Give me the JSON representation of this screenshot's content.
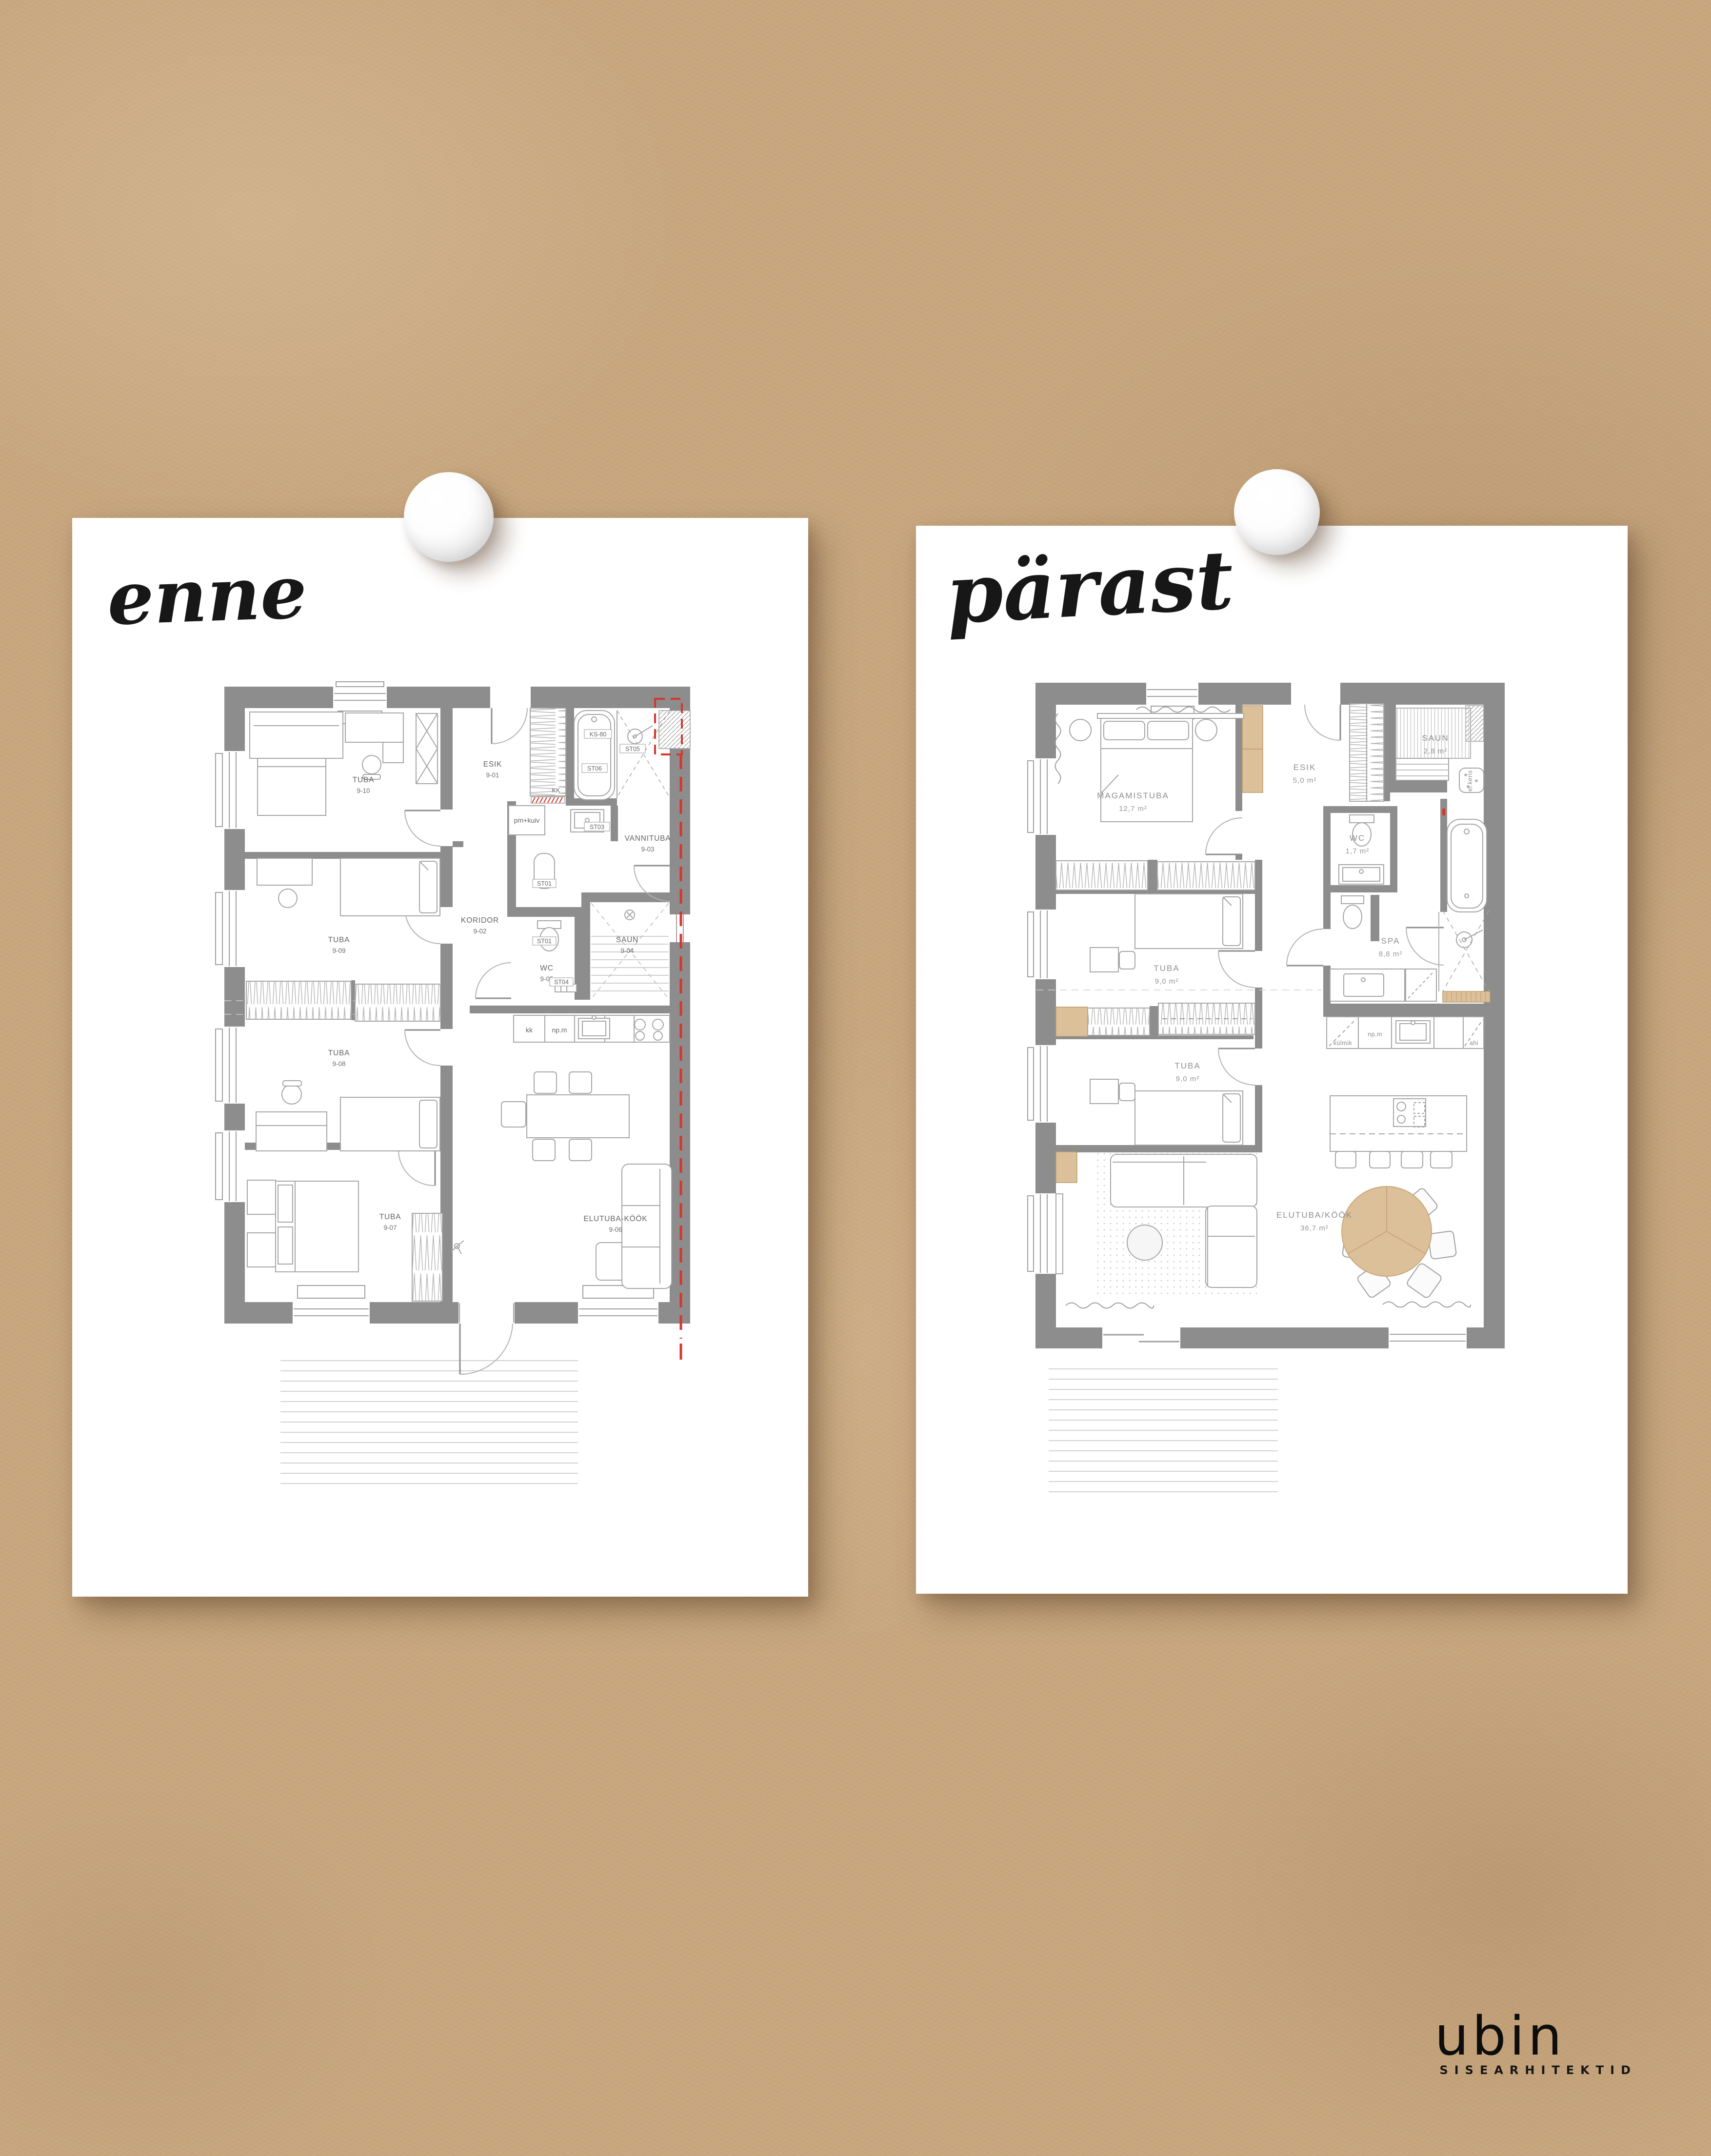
{
  "titles": {
    "left": "enne",
    "right": "pärast"
  },
  "logo": {
    "brand": "ubin",
    "tagline": "SISEARHITEKTID"
  },
  "left_plan": {
    "rooms": [
      {
        "name": "TUBA",
        "code": "9-10"
      },
      {
        "name": "TUBA",
        "code": "9-09"
      },
      {
        "name": "TUBA",
        "code": "9-08"
      },
      {
        "name": "TUBA",
        "code": "9-07"
      },
      {
        "name": "ESIK",
        "code": "9-01"
      },
      {
        "name": "KORIDOR",
        "code": "9-02"
      },
      {
        "name": "VANNITUBA",
        "code": "9-03"
      },
      {
        "name": "SAUN",
        "code": "9-04"
      },
      {
        "name": "WC",
        "code": "9-05"
      },
      {
        "name": "ELUTUBA-KÖÖK",
        "code": "9-06"
      }
    ],
    "fixtures": [
      "KS-80",
      "ST06",
      "ST05",
      "ST03",
      "ST01",
      "ST01",
      "ST04",
      "KK",
      "pm+kuiv",
      "kk",
      "np.m"
    ]
  },
  "right_plan": {
    "rooms": [
      {
        "name": "MAGAMISTUBA",
        "area": "12,7 m²"
      },
      {
        "name": "ESIK",
        "area": "5,0 m²"
      },
      {
        "name": "SAUN",
        "area": "2,8 m²"
      },
      {
        "name": "WC",
        "area": "1,7 m²"
      },
      {
        "name": "SPA",
        "area": "8,8 m²"
      },
      {
        "name": "TUBA",
        "area": "9,0 m²"
      },
      {
        "name": "TUBA",
        "area": "9,0 m²"
      },
      {
        "name": "ELUTUBA/KÖÖK",
        "area": "36,7 m²"
      }
    ],
    "fixtures": [
      "el.keris",
      "külmik",
      "np.m",
      "ahi"
    ]
  },
  "colors": {
    "kraft": "#c8a77e",
    "card": "#ffffff",
    "wall": "#8d8d8d",
    "line": "#a6a6a6",
    "red": "#d7352b",
    "wood": "#dcc09a"
  }
}
